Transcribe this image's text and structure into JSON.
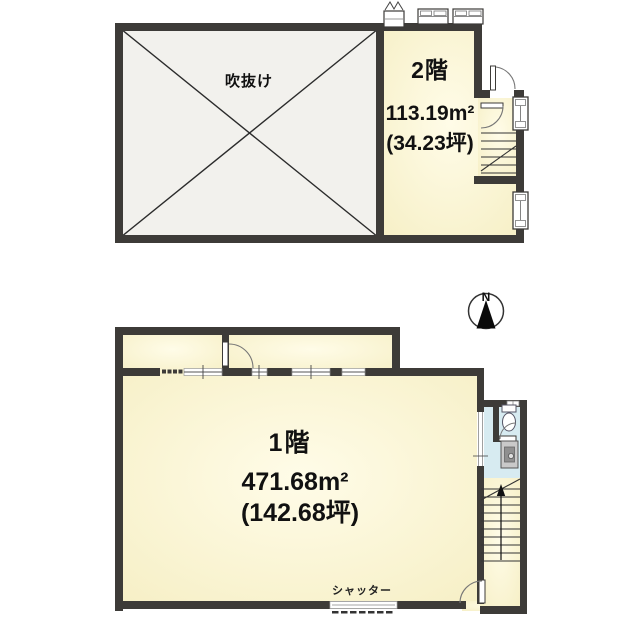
{
  "upper_plan": {
    "floor_label": "2階",
    "area_m2": "113.19m²",
    "area_tsubo": "(34.23坪)",
    "void_label": "吹抜け"
  },
  "lower_plan": {
    "floor_label": "1階",
    "area_m2": "471.68m²",
    "area_tsubo": "(142.68坪)",
    "shutter_label": "シャッター"
  },
  "compass": {
    "north_label": "N"
  },
  "colors": {
    "wall": "#3d3b38",
    "room_fill": "#f7f1c9",
    "room_fill_highlight": "#fffce8",
    "void_fill": "#f2f1ed",
    "wet_area_fill": "#d7ebf1",
    "fixture_line": "#555555"
  }
}
